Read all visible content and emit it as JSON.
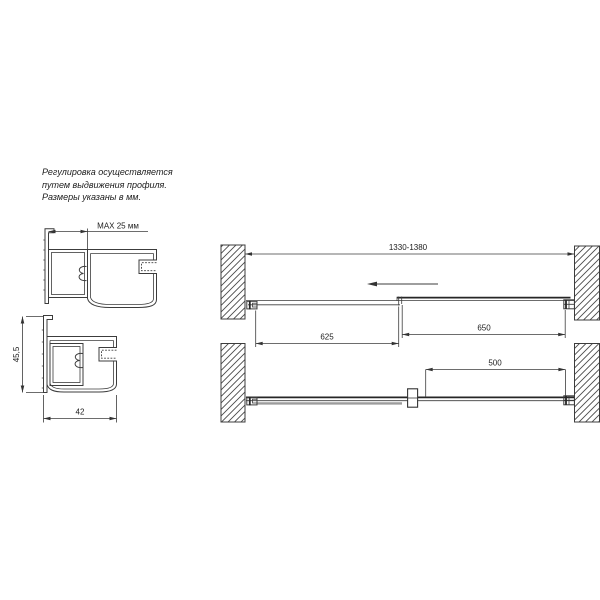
{
  "note": {
    "lines": [
      "Регулировка осуществляется",
      "путем выдвижения профиля.",
      "Размеры указаны в мм."
    ]
  },
  "profile_views": {
    "extended": {
      "max_extension": "MAX 25 мм"
    },
    "retracted": {
      "height": "45,5",
      "width": "42"
    }
  },
  "plan_views": {
    "closed": {
      "overall_width": "1330-1380",
      "fixed_panel": "625",
      "door_panel": "650"
    },
    "open": {
      "opening_width": "500"
    }
  },
  "colors": {
    "line": "#3c3c3c",
    "line_dark": "#262626",
    "panel_gray": "#9c9c9c",
    "background": "#ffffff",
    "text": "#1c1c1c"
  }
}
